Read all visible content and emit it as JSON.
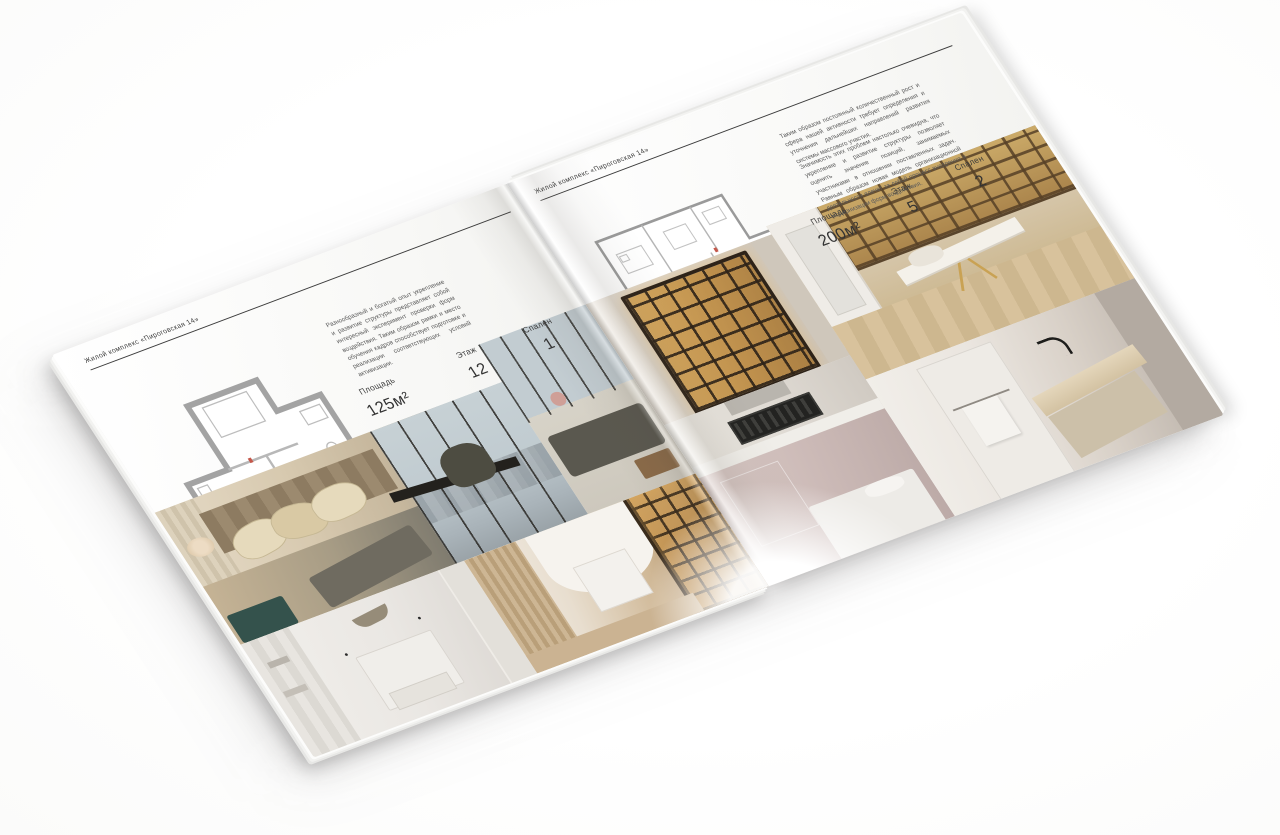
{
  "document": {
    "type": "Открытый разворот брошюры жилого комплекса (мокап на белом фоне)"
  },
  "colors": {
    "backdrop": "#ffffff",
    "page_background": "#f7f7f5",
    "text": "#3a3a3a",
    "rule": "#3c3c3c",
    "plan_walls": "#a3a3a3",
    "plan_accent_red": "#c4574a",
    "amber_shelving": "#c89a54",
    "teal_bench": "#34524c"
  },
  "left_page": {
    "header": "Жилой комплекс «Пироговская 14»",
    "description": "Разнообразный и богатый опыт укрепление и развитие структуры представляет собой интересный эксперимент проверки форм воздействия. Таким образом рамки и место обучения кадров способствует подготовке и реализации соответствующих условий активизации.",
    "specs": [
      {
        "label": "Площадь",
        "value": "125м²"
      },
      {
        "label": "Этаж",
        "value": "12"
      },
      {
        "label": "Спален",
        "value": "1"
      }
    ]
  },
  "right_page": {
    "header": "Жилой комплекс «Пироговская 14»",
    "description_1": "Таким образом постоянный количественный рост и сфера нашей активности требует определения и уточнения дальнейших направлений развития системы массового участия.",
    "description_2": "Значимость этих проблем настолько очевидна, что укрепление и развитие структуры позволяет оценить значение позиций, занимаемых участниками в отношении поставленных задач. Равным образом новая модель организационной деятельности влечет за собой процесс внедрения и модернизации форм воздействия.",
    "specs": [
      {
        "label": "Площадь",
        "value": "200м²"
      },
      {
        "label": "Этаж",
        "value": "5"
      },
      {
        "label": "Спален",
        "value": "2"
      }
    ]
  }
}
